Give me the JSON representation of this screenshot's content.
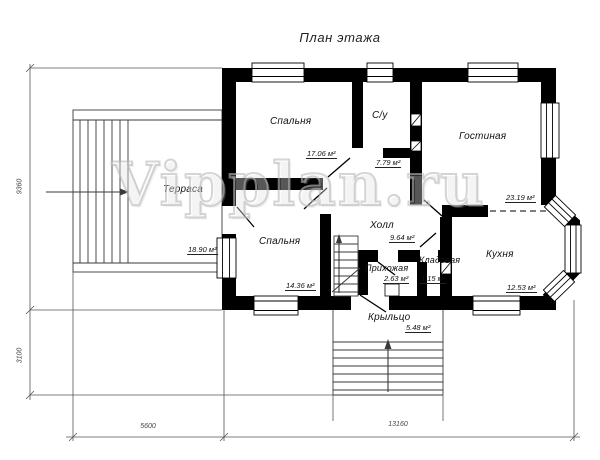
{
  "title": "План этажа",
  "watermark": "Vipplan.ru",
  "rooms": {
    "bedroom1": {
      "name": "Спальня",
      "area": "17.06 м²"
    },
    "bathroom": {
      "name": "С/у",
      "area": "7.79 м²"
    },
    "living": {
      "name": "Гостиная",
      "area": "23.19 м²"
    },
    "terrace": {
      "name": "Терраса",
      "area": "18.90 м²"
    },
    "bedroom2": {
      "name": "Спальня",
      "area": "14.36 м²"
    },
    "hall": {
      "name": "Холл",
      "area": "9.64 м²"
    },
    "entry": {
      "name": "Прихожая",
      "area": "2.63 м²"
    },
    "storage": {
      "name": "Кладовая",
      "area": "1.15 м²"
    },
    "kitchen": {
      "name": "Кухня",
      "area": "12.53 м²"
    },
    "porch": {
      "name": "Крыльцо",
      "area": "5.48 м²"
    }
  },
  "dimensions": {
    "left_upper": "9360",
    "left_lower": "3100",
    "bottom_left": "5600",
    "bottom_right": "13160"
  },
  "colors": {
    "wall": "#000000",
    "thin_line": "#3a3a3a",
    "dim_line": "#555555",
    "watermark_stroke": "#bdbdbd"
  }
}
